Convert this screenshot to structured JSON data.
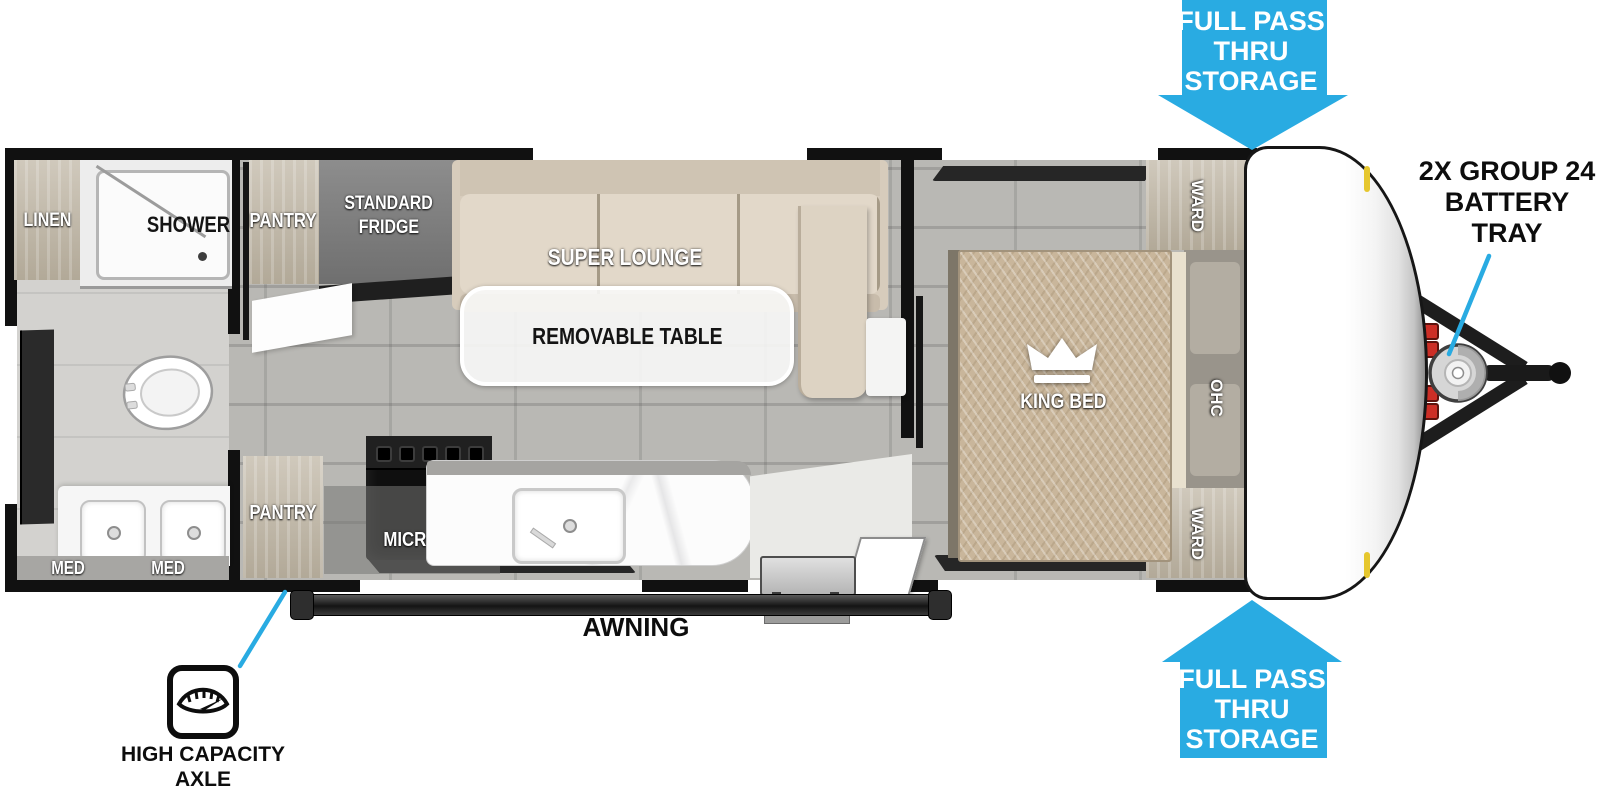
{
  "colors": {
    "accent_blue": "#29abe2",
    "wall_black": "#111111",
    "floor_gray": "#b9b8b4",
    "lounge_beige": "#dacfc0",
    "bed_tan": "#c9b69b",
    "cabinet_wood": "#c6bfb1",
    "fridge_gray": "#808080"
  },
  "callouts": {
    "storage_top": {
      "line1": "FULL PASS",
      "line2": "THRU",
      "line3": "STORAGE"
    },
    "storage_bottom": {
      "line1": "FULL PASS",
      "line2": "THRU",
      "line3": "STORAGE"
    },
    "battery": {
      "line1": "2X GROUP 24",
      "line2": "BATTERY",
      "line3": "TRAY"
    },
    "axle": {
      "line1": "HIGH CAPACITY",
      "line2": "AXLE"
    },
    "awning": "AWNING"
  },
  "labels": {
    "linen": "LINEN",
    "shower": "SHOWER",
    "pantry_top": "PANTRY",
    "fridge_line1": "STANDARD",
    "fridge_line2": "FRIDGE",
    "super_lounge": "SUPER LOUNGE",
    "removable_table": "REMOVABLE TABLE",
    "ward_top": "WARD",
    "king_bed": "KING BED",
    "ohc": "OHC",
    "ward_bottom": "WARD",
    "pantry_bottom": "PANTRY",
    "micro": "MICRO",
    "med_left": "MED",
    "med_right": "MED"
  }
}
